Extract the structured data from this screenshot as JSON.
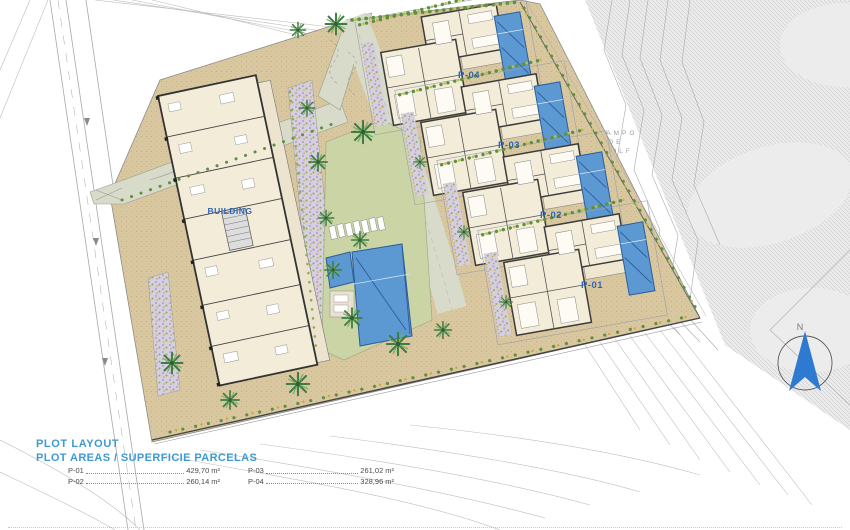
{
  "plan": {
    "building_label": "BUILDING",
    "villas": [
      {
        "label": "P-04"
      },
      {
        "label": "P-03"
      },
      {
        "label": "P-02"
      },
      {
        "label": "P-01"
      }
    ],
    "golf": {
      "line1": "CAMPO",
      "line2": "DE",
      "line3": "GOLF"
    },
    "compass_label": "N"
  },
  "legend": {
    "title": "PLOT LAYOUT",
    "subtitle": "PLOT AREAS / SUPERFICIE PARCELAS",
    "items": [
      {
        "label": "P-01",
        "value": "429,70",
        "unit": "m²"
      },
      {
        "label": "P-02",
        "value": "260,14",
        "unit": "m²"
      },
      {
        "label": "P-03",
        "value": "261,02",
        "unit": "m²"
      },
      {
        "label": "P-04",
        "value": "328,96",
        "unit": "m²"
      }
    ]
  },
  "colors": {
    "label_blue": "#2f66b8",
    "legend_blue": "#3e9ad2",
    "pool_blue": "#5c98d1",
    "ground_tan": "#d9c7a0",
    "lawn_green": "#cbd4a4",
    "path_gray": "#d8dbc9",
    "garden_lavender": "#d6cee1",
    "golf_gray": "#ececec"
  }
}
